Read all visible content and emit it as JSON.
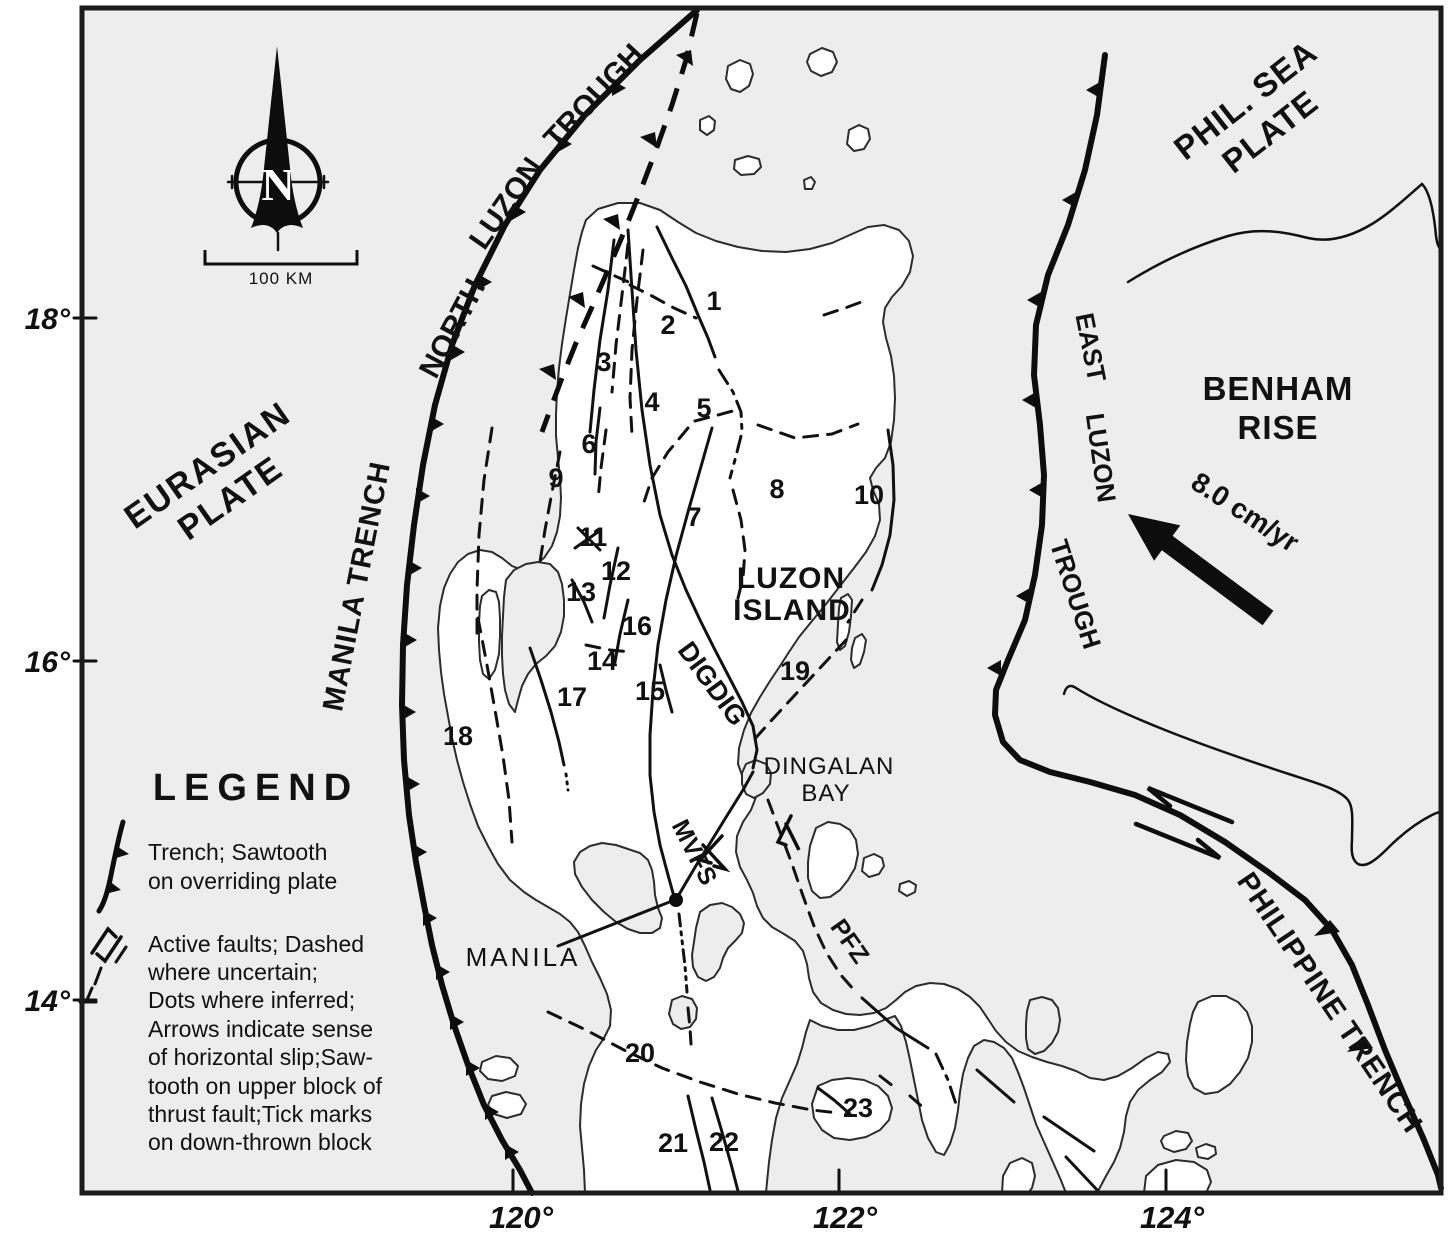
{
  "compass": {
    "letter": "N"
  },
  "scale": {
    "label": "100 KM"
  },
  "axes": {
    "lat": [
      "18°",
      "16°",
      "14°"
    ],
    "lon": [
      "120°",
      "122°",
      "124°"
    ]
  },
  "plates": {
    "eurasian": [
      "EURASIAN",
      "PLATE"
    ],
    "phil_sea": [
      "PHIL. SEA",
      "PLATE"
    ],
    "benham": [
      "BENHAM",
      "RISE"
    ],
    "rate_arrow": "8.0 cm/yr"
  },
  "trenches": {
    "manila": "MANILA TRENCH",
    "north_luzon": [
      "NORTH",
      "LUZON",
      "TROUGH"
    ],
    "east_luzon": [
      "EAST",
      "LUZON",
      "TROUGH"
    ],
    "philippine": "PHILIPPINE TRENCH"
  },
  "features": {
    "luzon": [
      "LUZON",
      "ISLAND"
    ],
    "dingalan": [
      "DINGALAN",
      "BAY"
    ],
    "manila_city": "MANILA",
    "digdig": "DIGDIG",
    "mvfs": "MVFS",
    "pfz": "PFZ"
  },
  "fault_numbers": [
    "1",
    "2",
    "3",
    "4",
    "5",
    "6",
    "7",
    "8",
    "9",
    "10",
    "11",
    "12",
    "13",
    "14",
    "15",
    "16",
    "17",
    "18",
    "19",
    "20",
    "21",
    "22",
    "23"
  ],
  "legend": {
    "title": "LEGEND",
    "trench_item": [
      "Trench; Sawtooth",
      "on overriding plate"
    ],
    "fault_item": [
      "Active faults; Dashed",
      "where uncertain;",
      "Dots where inferred;",
      "Arrows indicate sense",
      "of horizontal slip;Saw-",
      "tooth on upper block of",
      "thrust fault;Tick marks",
      "on down-thrown block"
    ]
  }
}
